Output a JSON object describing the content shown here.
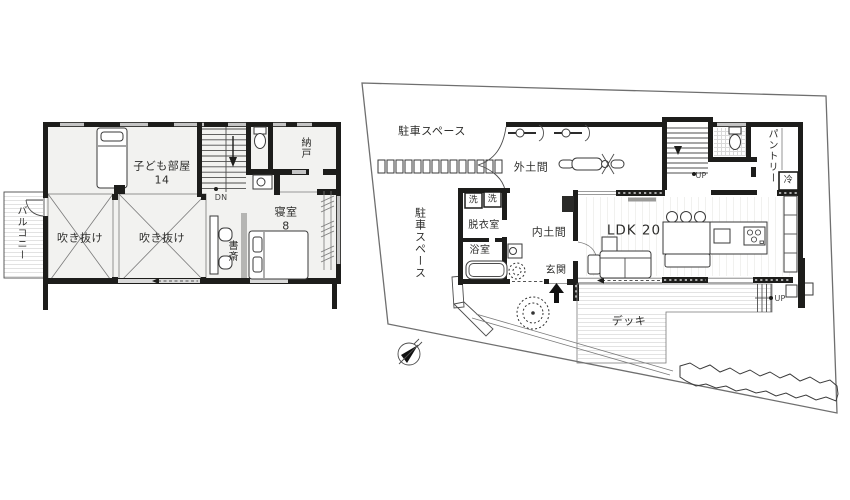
{
  "floor2": {
    "balcony": "バルコニー",
    "kids_room": "子ども部屋",
    "kids_room_size": "14",
    "stairs_down": "DN",
    "storage": "納戸",
    "bedroom": "寝室",
    "bedroom_size": "8",
    "study": "書斎",
    "void1": "吹き抜け",
    "void2": "吹き抜け"
  },
  "floor1": {
    "parking_top": "駐車スペース",
    "parking_left": "駐車スペース",
    "outdoor_doma": "外土間",
    "washer1": "洗",
    "washer2": "洗",
    "dressing_room": "脱衣室",
    "bathroom": "浴室",
    "inner_doma": "内土間",
    "entrance": "玄関",
    "ldk": "LDK 20",
    "deck": "デッキ",
    "pantry": "パントリー",
    "fridge": "冷",
    "stairs_up": "UP",
    "deck_up": "UP"
  },
  "colors": {
    "wall": "#1d1d1b",
    "thin_line": "#4d4d4d",
    "window_gray": "#c4c4c4",
    "floor_tint": "#f2f2f0",
    "stripe": "#e3e3e3"
  }
}
